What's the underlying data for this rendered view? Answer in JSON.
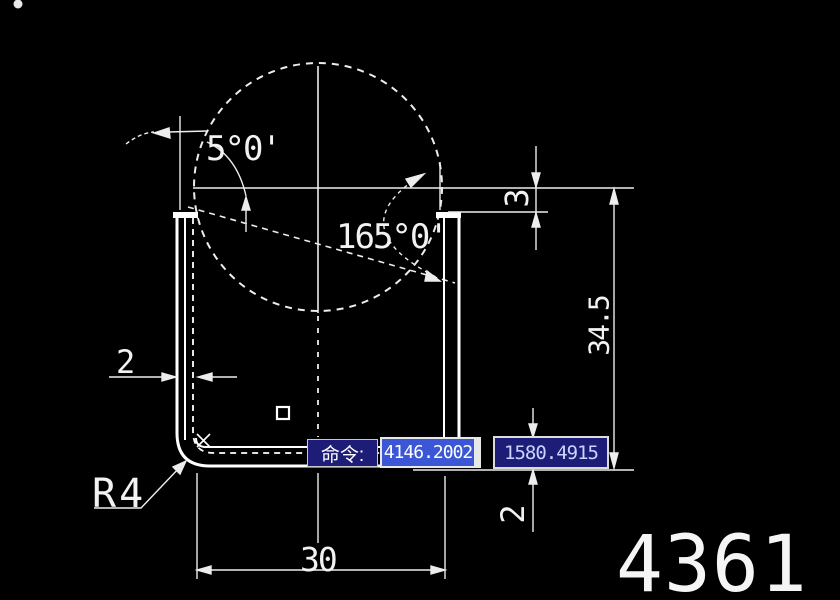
{
  "window": {
    "background": "#000000",
    "line_color": "#f0f0f0"
  },
  "drawing": {
    "dims": {
      "angle_small": "5°0'",
      "angle_large": "165°0'",
      "gap": "3",
      "height": "34.5",
      "web_thickness": "2",
      "flange_thickness": "2",
      "width": "30",
      "fillet": "R4"
    },
    "part_number": "4361"
  },
  "command_bar": {
    "prompt": "命令:",
    "coord_x": "4146.2002",
    "coord_y": "1580.4915",
    "prompt_bg": "#1d1d78",
    "highlight_bg": "#3b57d6",
    "coord_text_color": "#c9d5ff"
  }
}
